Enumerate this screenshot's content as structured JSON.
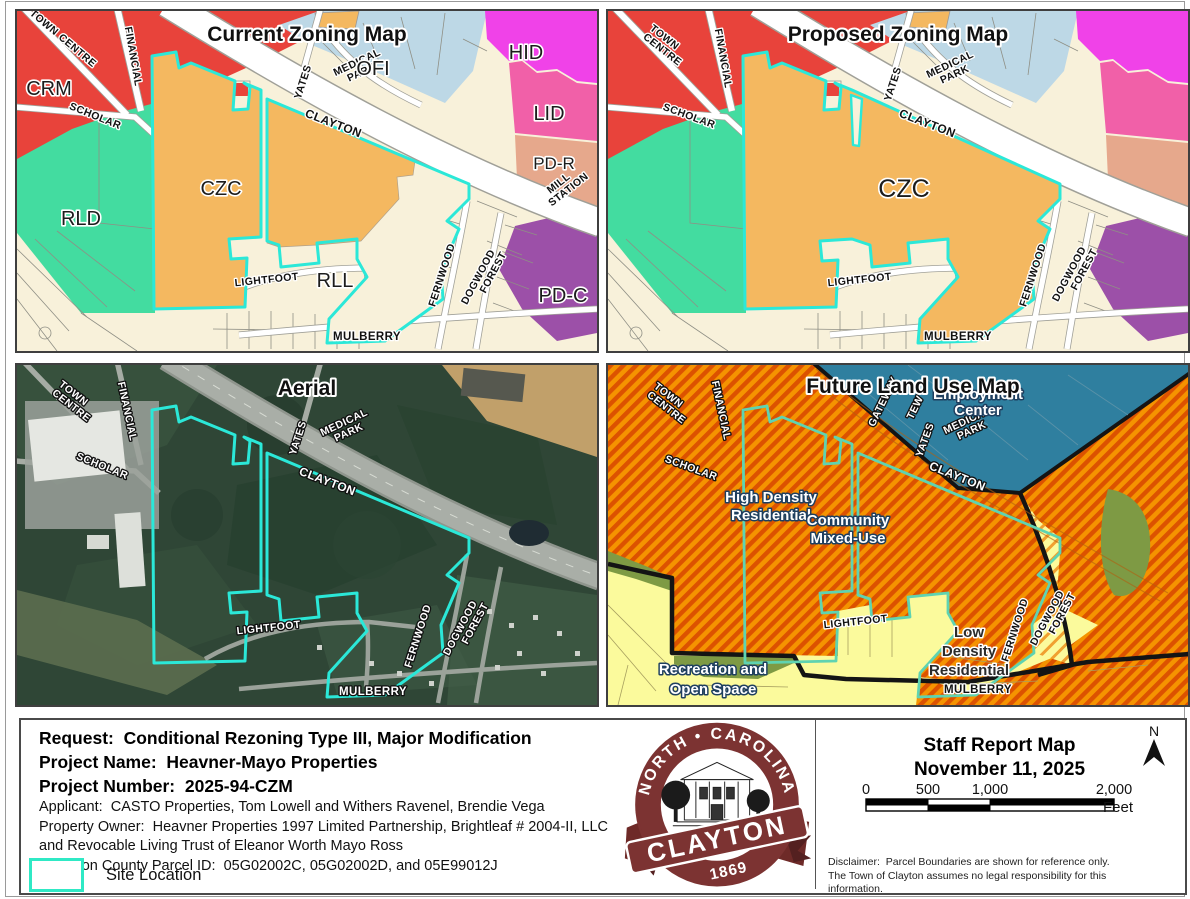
{
  "titles": {
    "current": "Current Zoning Map",
    "proposed": "Proposed Zoning Map",
    "aerial": "Aerial",
    "flu": "Future Land Use Map"
  },
  "streets": {
    "town_centre": [
      "TOWN",
      "CENTRE"
    ],
    "financial": "FINANCIAL",
    "scholar": "SCHOLAR",
    "clayton": "CLAYTON",
    "yates": "YATES",
    "medical_park": [
      "MEDICAL",
      "PARK"
    ],
    "lightfoot": "LIGHTFOOT",
    "fernwood": "FERNWOOD",
    "dogwood_forest": [
      "DOGWOOD",
      "FOREST"
    ],
    "mulberry": "MULBERRY",
    "mill_station": [
      "MILL",
      "STATION"
    ],
    "gateway": "GATEWAY",
    "tew": "TEW"
  },
  "zones": {
    "crm": "CRM",
    "rld": "RLD",
    "czc": "CZC",
    "ofi": "OFI",
    "hid": "HID",
    "lid": "LID",
    "pdr": "PD-R",
    "pdc": "PD-C",
    "rll": "RLL"
  },
  "flu": {
    "high_density": [
      "High Density",
      "Residential"
    ],
    "community_mixed_use": [
      "Community",
      "Mixed-Use"
    ],
    "low_density": [
      "Low",
      "Density",
      "Residential"
    ],
    "recreation": [
      "Recreation and",
      "Open Space"
    ],
    "employment_center": [
      "Employment",
      "Center"
    ]
  },
  "info": {
    "request": "Request:  Conditional Rezoning Type III, Major Modification",
    "project_name": "Project Name:  Heavner-Mayo Properties",
    "project_number": "Project Number:  2025-94-CZM",
    "applicant": "Applicant:  CASTO Properties, Tom Lowell and Withers Ravenel, Brendie Vega",
    "owner1": "Property Owner:  Heavner Properties 1997 Limited Partnership, Brightleaf # 2004-II, LLC",
    "owner2": "and Revocable Living Trust of Eleanor Worth Mayo Ross",
    "parcel_id": "Johnston County Parcel ID:  05G02002C, 05G02002D, and 05E99012J"
  },
  "legend": {
    "site_location": "Site Location"
  },
  "logo": {
    "arc_text": "NORTH • CAROLINA",
    "name": "CLAYTON",
    "year": "1869"
  },
  "staff": {
    "title": "Staff Report Map",
    "date": "November 11, 2025",
    "scale_ticks": [
      "0",
      "500",
      "1,000",
      "2,000"
    ],
    "unit": "Feet",
    "north_label": "N",
    "disclaimer": "Disclaimer:  Parcel Boundaries are shown for reference only.  The Town of Clayton assumes no legal responsibility for this information."
  },
  "colors": {
    "site_outline_cyan": "#2BE8D8",
    "flu_site_outline_mint": "#5FD3B1",
    "zone_crm_red": "#E8433B",
    "zone_rld_green": "#43DCA0",
    "zone_czc_orange": "#F4B860",
    "zone_ofi_blue": "#BDD8E6",
    "zone_hid_magenta": "#F042E8",
    "zone_lid_pink": "#F160A8",
    "zone_pdr_salmon": "#E6A88C",
    "zone_pdc_purple": "#9C50A8",
    "cream_base": "#F8F1DA",
    "flu_orange": "#F59300",
    "flu_orange_stripe": "#DC5200",
    "flu_teal": "#2F7F9F",
    "flu_yellow": "#FBFA9C",
    "flu_olive": "#7E9A44",
    "logo_maroon": "#7C3332"
  }
}
